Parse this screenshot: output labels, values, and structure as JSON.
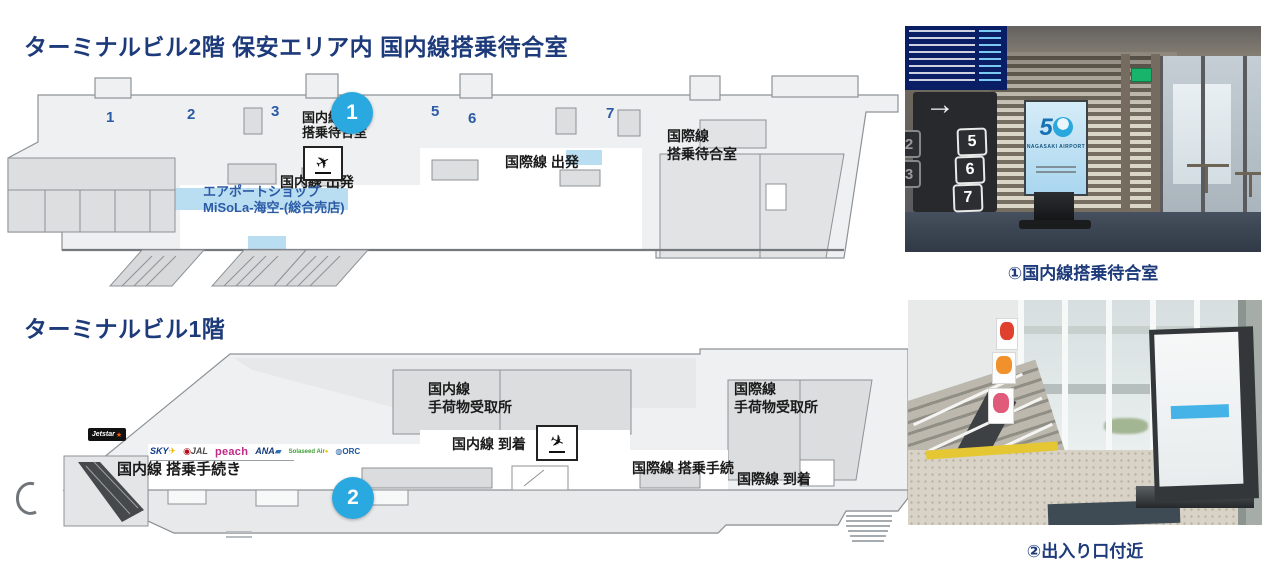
{
  "colors": {
    "title_navy": "#1d3a7a",
    "gate_blue": "#2b5aa6",
    "marker_blue": "#29a9e0",
    "map_fill": "#eef0f1",
    "map_stroke": "#8e9296",
    "light_blue": "#badef1"
  },
  "floor2": {
    "title": "ターミナルビル2階 保安エリア内 国内線搭乗待合室",
    "marker": "1",
    "gates": [
      "1",
      "2",
      "3",
      "5",
      "6",
      "7"
    ],
    "labels": {
      "domestic_waiting_1": "国内線",
      "domestic_waiting_2": "搭乗待合室",
      "domestic_departure": "国内線 出発",
      "international_departure": "国際線 出発",
      "international_waiting_1": "国際線",
      "international_waiting_2": "搭乗待合室",
      "shop_1": "エアポートショップ",
      "shop_2": "MiSoLa-海空-(総合売店)"
    }
  },
  "floor1": {
    "title": "ターミナルビル1階",
    "marker": "2",
    "labels": {
      "domestic_checkin": "国内線 搭乗手続き",
      "domestic_baggage_1": "国内線",
      "domestic_baggage_2": "手荷物受取所",
      "domestic_arrival": "国内線 到着",
      "international_checkin": "国際線 搭乗手続",
      "international_baggage_1": "国際線",
      "international_baggage_2": "手荷物受取所",
      "international_arrival": "国際線 到着"
    },
    "airlines": {
      "jetstar": "Jetstar",
      "skymark": "SKY",
      "jal": "JAL",
      "peach": "peach",
      "ana": "ANA",
      "solaseed": "Solaseed Air",
      "orc": "ORC"
    }
  },
  "photos": [
    {
      "caption": "①国内線搭乗待合室",
      "sign_arrow": "→",
      "sign_gates": [
        "5",
        "6",
        "7"
      ],
      "sign_gates_partial": [
        "2",
        "3"
      ],
      "kiosk_logo_number": "5",
      "kiosk_logo_name": "NAGASAKI AIRPORT"
    },
    {
      "caption": "②出入り口付近"
    }
  ],
  "icons": {
    "departure_plane": "✈",
    "arrival_plane": "✈",
    "arrow_right": "→"
  }
}
